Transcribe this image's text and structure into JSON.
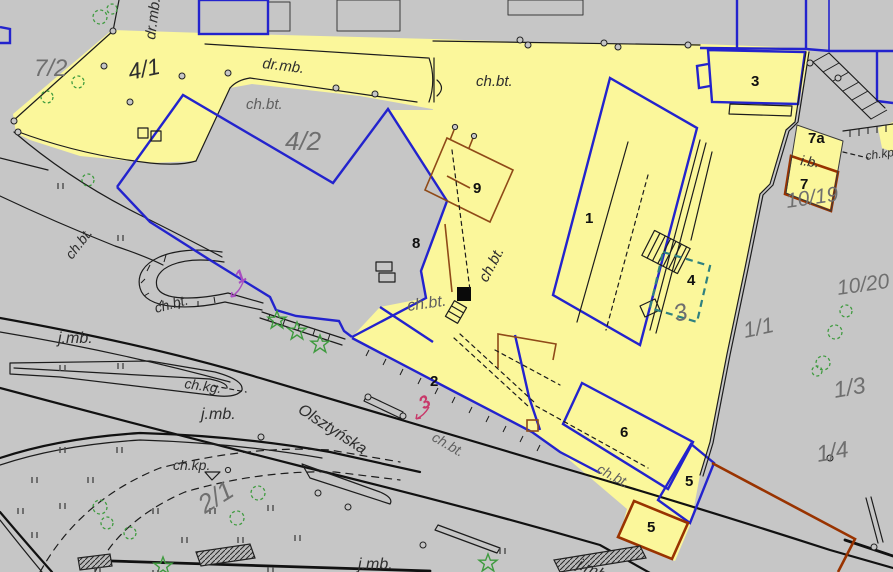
{
  "map_type": "cadastral-survey-map",
  "street": {
    "name": "Olsztyńska"
  },
  "parcels": [
    {
      "number": "7/2"
    },
    {
      "number": "4/1"
    },
    {
      "number": "4/2"
    },
    {
      "number": "1/1"
    },
    {
      "number": "1/3"
    },
    {
      "number": "1/4"
    },
    {
      "number": "2/1"
    },
    {
      "number": "10/19"
    },
    {
      "number": "10/20"
    }
  ],
  "buildings": [
    {
      "number": "1"
    },
    {
      "number": "2"
    },
    {
      "number": "3"
    },
    {
      "number": "4"
    },
    {
      "number": "5"
    },
    {
      "number": "5"
    },
    {
      "number": "6"
    },
    {
      "number": "7"
    },
    {
      "number": "7a"
    },
    {
      "number": "8"
    },
    {
      "number": "9"
    }
  ],
  "surfaces": {
    "road_bituminous": "dr.mb.",
    "sidewalk_concrete": "ch.bt.",
    "sidewalk_granite": "ch.kg.",
    "sidewalk_paving": "ch.kp.",
    "roadway_bituminous": "j.mb.",
    "other_building": "i.b.",
    "sidewalk_clipped": "ch.kp."
  },
  "annotations": [
    {
      "text": "1",
      "color": "magenta"
    },
    {
      "text": "3",
      "color": "red"
    },
    {
      "text": "3",
      "color": "gray"
    }
  ],
  "colors": {
    "background": "#c6c6c6",
    "highlight_yellow": "#fbf79b",
    "boundary_blue": "#2323cd",
    "boundary_brown": "#8f4a18",
    "structure_brown": "#993300",
    "proposed_teal": "#2e8080",
    "vegetation_green": "#3f9b3f",
    "annotation_magenta": "#a84fc0",
    "annotation_red": "#c8396a",
    "label_gray": "#6f6f6f",
    "label_dark": "#2e2e2e"
  }
}
